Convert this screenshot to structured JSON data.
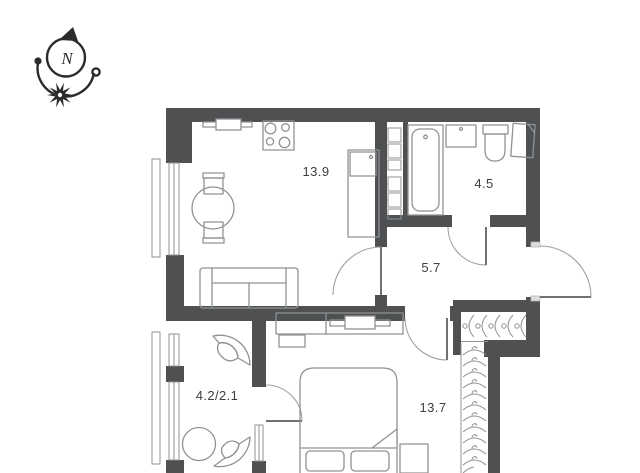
{
  "plan": {
    "type_label": "apartment floor plan",
    "compass": {
      "north_label": "N"
    },
    "rooms": [
      {
        "name": "kitchen-living-room",
        "area_label": "13.9"
      },
      {
        "name": "bathroom",
        "area_label": "4.5"
      },
      {
        "name": "hallway",
        "area_label": "5.7"
      },
      {
        "name": "balcony",
        "area_label": "4.2/2.1"
      },
      {
        "name": "bedroom",
        "area_label": "13.7"
      }
    ]
  },
  "colors": {
    "background": "#ffffff",
    "wall": "#4e5052",
    "furniture": "#8f9294",
    "door": "#9ea1a3",
    "door_leaf": "#6f7173",
    "text": "#3c3e40",
    "compass": "#2b2b2b"
  }
}
